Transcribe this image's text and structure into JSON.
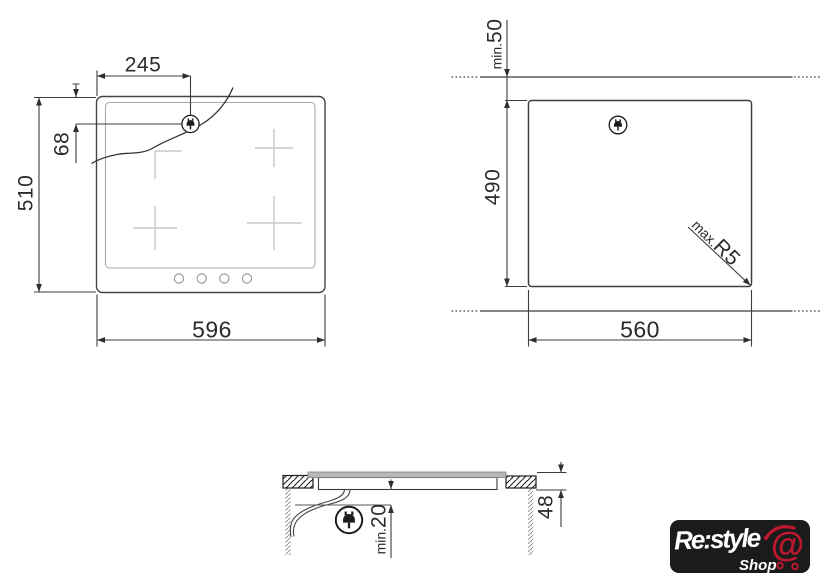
{
  "hob_view": {
    "width_label": "596",
    "height_label": "510",
    "plug_x_label": "245",
    "plug_y_label": "68"
  },
  "cutout_view": {
    "width_label": "560",
    "height_label": "490",
    "clearance_prefix": "min.",
    "clearance_value": "50",
    "radius_prefix": "max.",
    "radius_value": "R5"
  },
  "section_view": {
    "height_label": "48",
    "clearance_prefix": "min.",
    "clearance_value": "20"
  },
  "icons": {
    "power_plug": "power-plug-icon",
    "shopping_cart": "cart-at-icon"
  },
  "colors": {
    "drawing_line": "#3c3c3c",
    "light_mark": "#c8c8c8",
    "logo_background": "#1b1b1b",
    "logo_accent_red": "#c0192f"
  },
  "logo": {
    "brand": "Re:style",
    "sub": "Shop",
    "cart_symbol": "@"
  }
}
